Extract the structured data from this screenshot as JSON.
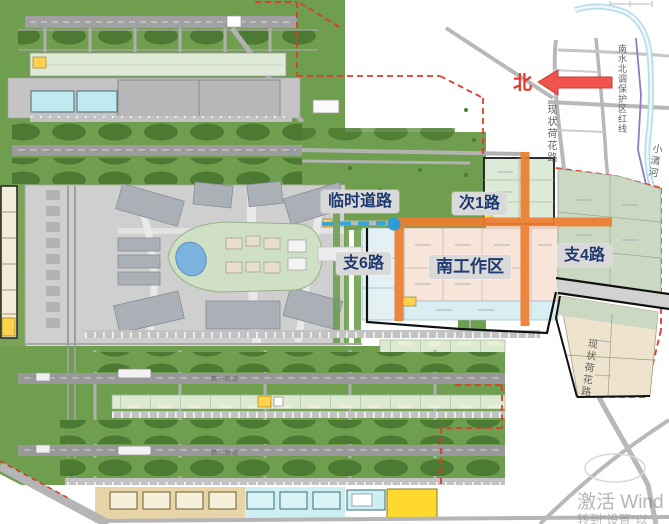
{
  "map_annotations": {
    "temp_road": "临时道路",
    "secondary_road_1": "次1路",
    "branch_road_6": "支6路",
    "south_work_area": "南工作区",
    "branch_road_4": "支4路",
    "north_indicator": "北"
  },
  "existing_roads": {
    "hehua_road_north": "现状荷花路",
    "hehua_road_south": "现状荷花路",
    "water_diversion_redline": "南水北调保护区红线",
    "xiaoqing_river": "小清河"
  },
  "airfield": {
    "runway_west_1": "西一跑道",
    "runway_west_2": "西二跑道"
  },
  "watermark": {
    "line1": "激活 Wind",
    "line2": "转到“设置”以"
  },
  "colors": {
    "label_text": "#1e3a6e",
    "label_background": "#d9d9d9",
    "planned_road_orange": "#ed7d31",
    "temp_road_blue": "#36a5dd",
    "north_red": "#e8352b",
    "redline_dash": "#e0392e",
    "field_green": "#6f9e4f"
  }
}
